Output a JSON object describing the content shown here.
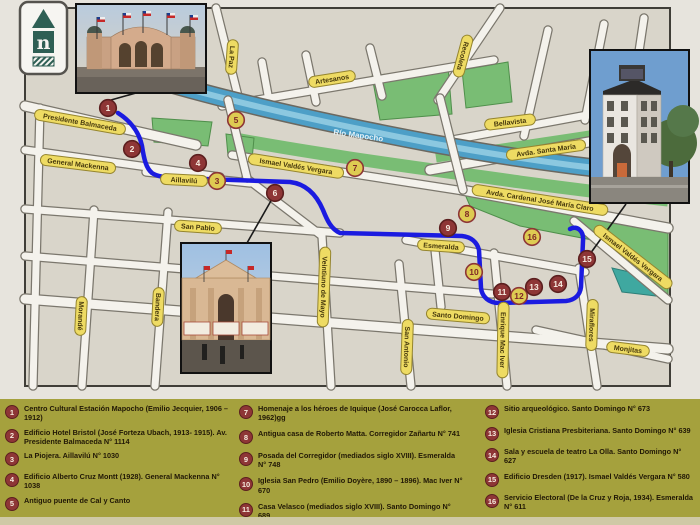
{
  "logo": {
    "letter": "n"
  },
  "colors": {
    "route": "#1b1be0",
    "marker_red": "#8e3636",
    "marker_red_ring": "#5c1f1f",
    "marker_yellow": "#decb52",
    "marker_yellow_ring": "#8e3636",
    "street_label_bg": "#eedb63",
    "street_label_border": "#95852e",
    "street_label_text": "#46380c",
    "legend_bg": "#a5a13d",
    "legend_text": "#211806",
    "river": "#4d9fc7",
    "park_green": "#79bd74",
    "teal_area": "#3fa8a0"
  },
  "map": {
    "river_label": "Río Mapocho",
    "streets": [
      {
        "label": "Presidente Balmaceda",
        "x": 80,
        "y": 122,
        "rot": 10
      },
      {
        "label": "General Mackenna",
        "x": 78,
        "y": 164,
        "rot": 7
      },
      {
        "label": "Aillavilú",
        "x": 184,
        "y": 180,
        "rot": 3
      },
      {
        "label": "San Pablo",
        "x": 198,
        "y": 227,
        "rot": 4
      },
      {
        "label": "La Paz",
        "x": 232,
        "y": 57,
        "rot": 94
      },
      {
        "label": "Artesanos",
        "x": 332,
        "y": 79,
        "rot": -9
      },
      {
        "label": "Recoleta",
        "x": 463,
        "y": 56,
        "rot": 105
      },
      {
        "label": "Bellavista",
        "x": 510,
        "y": 122,
        "rot": -7
      },
      {
        "label": "Avda. Santa María",
        "x": 546,
        "y": 150,
        "rot": -8
      },
      {
        "label": "Ismael Valdés Vergara",
        "x": 296,
        "y": 166,
        "rot": 9
      },
      {
        "label": "Avda. Cardenal José María Claro",
        "x": 540,
        "y": 200,
        "rot": 9
      },
      {
        "label": "Ismael Valdés Vergara",
        "x": 633,
        "y": 257,
        "rot": 38
      },
      {
        "label": "Esmeralda",
        "x": 441,
        "y": 246,
        "rot": 4
      },
      {
        "label": "Santo Domingo",
        "x": 458,
        "y": 316,
        "rot": 5
      },
      {
        "label": "Monjitas",
        "x": 628,
        "y": 349,
        "rot": 7
      },
      {
        "label": "Morandé",
        "x": 81,
        "y": 316,
        "rot": 93
      },
      {
        "label": "Bandera",
        "x": 158,
        "y": 307,
        "rot": 93
      },
      {
        "label": "Veintiuno de Mayo",
        "x": 324,
        "y": 287,
        "rot": 92
      },
      {
        "label": "San Antonio",
        "x": 407,
        "y": 347,
        "rot": 92
      },
      {
        "label": "Enrique Mac Iver",
        "x": 503,
        "y": 340,
        "rot": 91
      },
      {
        "label": "Miraflores",
        "x": 592,
        "y": 325,
        "rot": 92
      }
    ],
    "markers": [
      {
        "n": "1",
        "x": 108,
        "y": 108,
        "style": "red"
      },
      {
        "n": "2",
        "x": 132,
        "y": 149,
        "style": "red"
      },
      {
        "n": "3",
        "x": 217,
        "y": 181,
        "style": "yellow"
      },
      {
        "n": "4",
        "x": 198,
        "y": 163,
        "style": "red"
      },
      {
        "n": "5",
        "x": 236,
        "y": 120,
        "style": "yellow"
      },
      {
        "n": "6",
        "x": 275,
        "y": 193,
        "style": "red"
      },
      {
        "n": "7",
        "x": 355,
        "y": 168,
        "style": "yellow"
      },
      {
        "n": "8",
        "x": 467,
        "y": 214,
        "style": "yellow"
      },
      {
        "n": "9",
        "x": 448,
        "y": 228,
        "style": "red"
      },
      {
        "n": "10",
        "x": 474,
        "y": 272,
        "style": "yellow"
      },
      {
        "n": "11",
        "x": 502,
        "y": 292,
        "style": "red"
      },
      {
        "n": "12",
        "x": 519,
        "y": 296,
        "style": "yellow"
      },
      {
        "n": "13",
        "x": 534,
        "y": 287,
        "style": "red"
      },
      {
        "n": "14",
        "x": 558,
        "y": 284,
        "style": "red"
      },
      {
        "n": "15",
        "x": 587,
        "y": 259,
        "style": "red"
      },
      {
        "n": "16",
        "x": 532,
        "y": 237,
        "style": "yellow"
      }
    ],
    "route": {
      "path": "M 118,113 C 129,120 139,131 142,146 C 144,159 146,168 152,173 C 156,176 166,178 176,178 L 290,182 C 307,184 317,196 323,210 C 327,220 331,229 340,233 L 462,236 C 471,237 477,242 479,250 L 481,288 C 482,297 489,303 499,303 L 566,301 C 575,300 580,295 581,287 L 583,241 C 584,231 577,225 570,229"
    }
  },
  "legend": {
    "columns": [
      {
        "items": [
          {
            "n": "1",
            "text": "Centro Cultural Estación Mapocho (Emilio Jecquier, 1906 – 1912)"
          },
          {
            "n": "2",
            "text": "Edificio Hotel Bristol (José Forteza Ubach, 1913- 1915). Av. Presidente Balmaceda N° 1114"
          },
          {
            "n": "3",
            "text": "La Piojera. Aillavilú N° 1030"
          },
          {
            "n": "4",
            "text": "Edificio Alberto Cruz Montt (1928). General Mackenna N° 1038"
          },
          {
            "n": "5",
            "text": "Antiguo puente de Cal y Canto"
          },
          {
            "n": "6",
            "text": "Mercado Central (M. Aldunate, F. Vivaceta, 1868 – 1872)"
          }
        ]
      },
      {
        "items": [
          {
            "n": "7",
            "text": "Homenaje a los héroes de Iquique (José Carocca Laflor, 1962)gg"
          },
          {
            "n": "8",
            "text": "Antigua casa de Roberto Matta. Corregidor Zañartu N° 741"
          },
          {
            "n": "9",
            "text": "Posada del Corregidor (mediados siglo XVIII). Esmeralda N° 748"
          },
          {
            "n": "10",
            "text": "Iglesia San Pedro (Emilio Doyère, 1890 – 1896). Mac Iver N° 670"
          },
          {
            "n": "11",
            "text": "Casa Velasco (mediados siglo XVIII). Santo Domingo N° 689"
          }
        ]
      },
      {
        "items": [
          {
            "n": "12",
            "text": "Sitio arqueológico. Santo Domingo N° 673"
          },
          {
            "n": "13",
            "text": "Iglesia Cristiana Presbiteriana. Santo Domingo N° 639"
          },
          {
            "n": "14",
            "text": "Sala y escuela de teatro La Olla. Santo Domingo N° 627"
          },
          {
            "n": "15",
            "text": "Edificio Dresden (1917). Ismael Valdés Vergara N° 580"
          },
          {
            "n": "16",
            "text": "Servicio Electoral (De la Cruz y Roja, 1934). Esmeralda N° 611"
          }
        ]
      }
    ]
  }
}
